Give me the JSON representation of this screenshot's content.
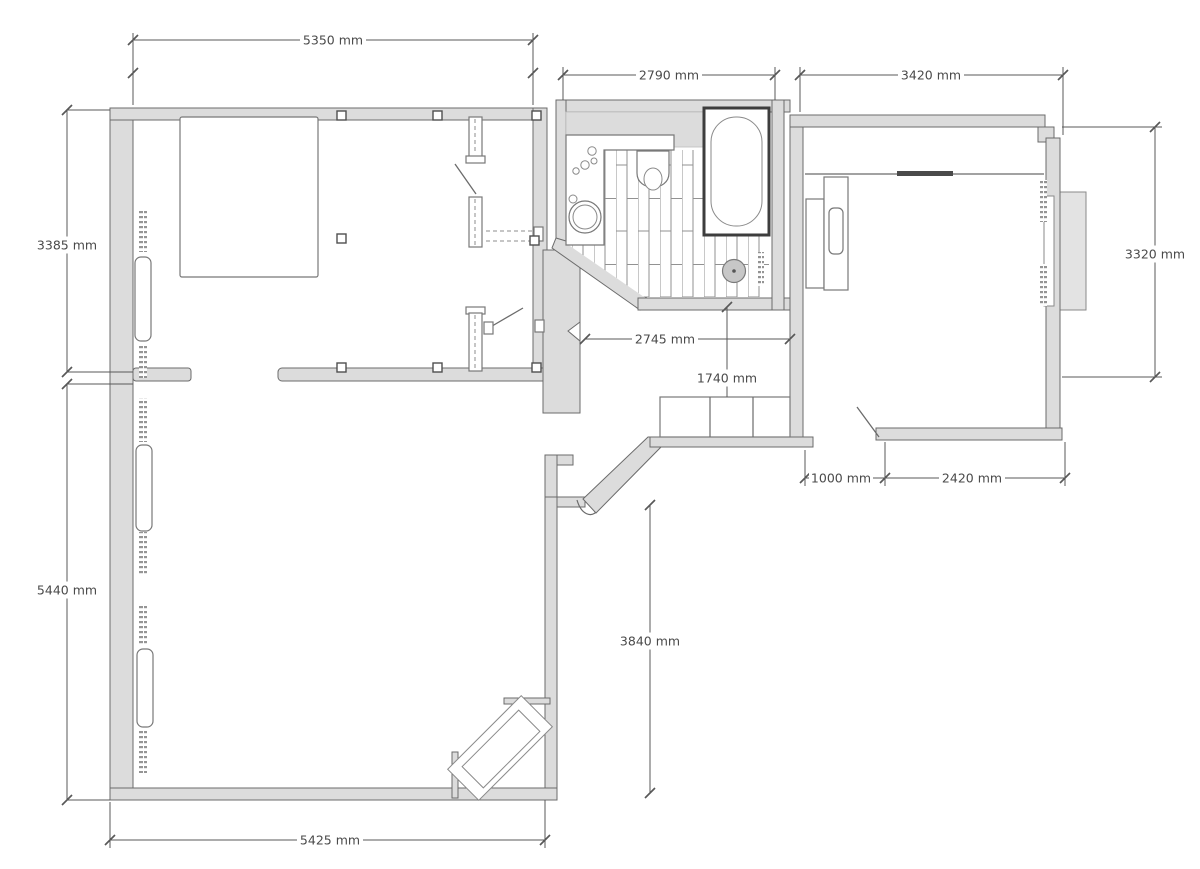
{
  "drawing": {
    "type": "apartment-floor-plan",
    "unit": "mm"
  },
  "dimensions": {
    "bedroom_top_width": "5350 mm",
    "bathroom_top_width": "2790 mm",
    "right_room_top_width": "3420 mm",
    "bedroom_left_height": "3385 mm",
    "living_room_left_height": "5440 mm",
    "right_room_right_height": "3320 mm",
    "hallway_width": "2745 mm",
    "hallway_height": "1740 mm",
    "entry_door_offset": "1000 mm",
    "right_room_bottom_width": "2420 mm",
    "living_room_inner_height": "3840 mm",
    "living_room_bottom_width": "5425 mm"
  },
  "colors": {
    "wall_fill": "#dcdcdc",
    "line": "#6b6b6b",
    "dimension_line": "#585858",
    "text": "#4a4a4a",
    "drain_fill": "#c7c7c7",
    "window_bay_fill": "#e3e3e3"
  }
}
